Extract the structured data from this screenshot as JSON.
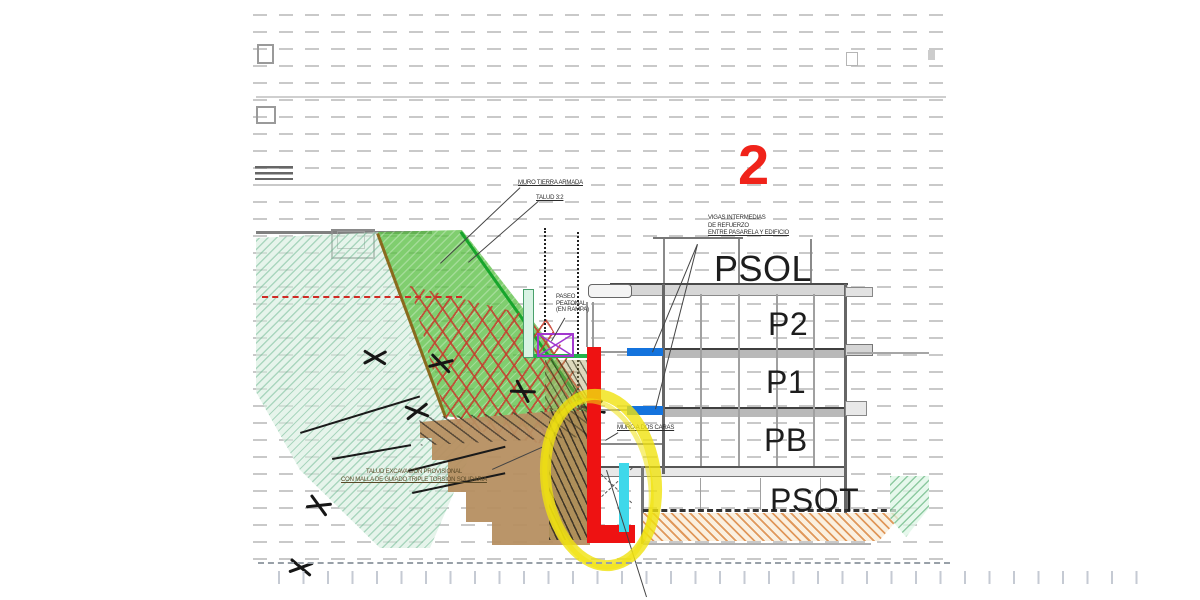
{
  "marker": {
    "number": "2",
    "color": "#f0231a"
  },
  "floors": [
    "PSOL",
    "P2",
    "P1",
    "PB",
    "PSOT"
  ],
  "labels": {
    "muro_tierra_armada": "MURO TIERRA ARMADA",
    "talud": "TALUD 3:2",
    "vigas": {
      "l1": "VIGAS INTERMEDIAS",
      "l2": "DE REFUERZO",
      "l3": "ENTRE PASARELA Y EDIFICIO"
    },
    "paseo": {
      "l1": "PASEO",
      "l2": "PEATONAL",
      "l3": "(EN RAMPA)"
    },
    "muro_dos_caras": "MURO A DOS CARAS",
    "talud_excavacion": {
      "l1": "TALUD EXCAVACIÓN PROVISIONAL",
      "l2": "CON MALLA DE GUIADO TRIPLE TORSIÓN SOLIDARIA"
    }
  },
  "colors": {
    "highlight_circle": "#f0e20e",
    "wall_highlight_red": "#ee1212",
    "drain_highlight_cyan": "#3fd8ea",
    "vigas_refuerzo_blue": "#1473dd",
    "paseo_strip_green": "#24b24a",
    "slope_green": "#5cc046",
    "mesh_lattice_red": "#c53c2d",
    "terrain_brown": "#b68f61",
    "detail_purple": "#a238cf"
  }
}
